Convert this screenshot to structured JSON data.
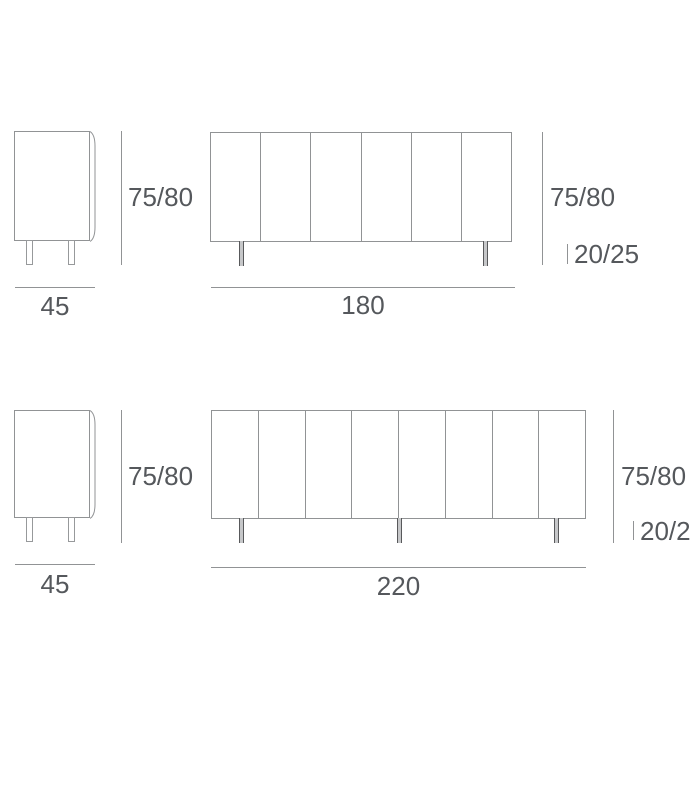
{
  "colors": {
    "background": "#ffffff",
    "line": "#919395",
    "leg_edge": "#58595b",
    "leg_fill": "#c6c7c9",
    "text": "#55585c"
  },
  "figures": {
    "small_sideboard": {
      "side_view": {
        "width_label": "45",
        "height_label": "75/80",
        "legs": 2
      },
      "front_view": {
        "width_label": "180",
        "height_label": "75/80",
        "leg_height_label": "20/25",
        "door_panels": 6,
        "legs": 2
      }
    },
    "large_sideboard": {
      "side_view": {
        "width_label": "45",
        "height_label": "75/80",
        "legs": 2
      },
      "front_view": {
        "width_label": "220",
        "height_label": "75/80",
        "leg_height_label": "20/2",
        "door_panels": 8,
        "legs": 3
      }
    }
  }
}
